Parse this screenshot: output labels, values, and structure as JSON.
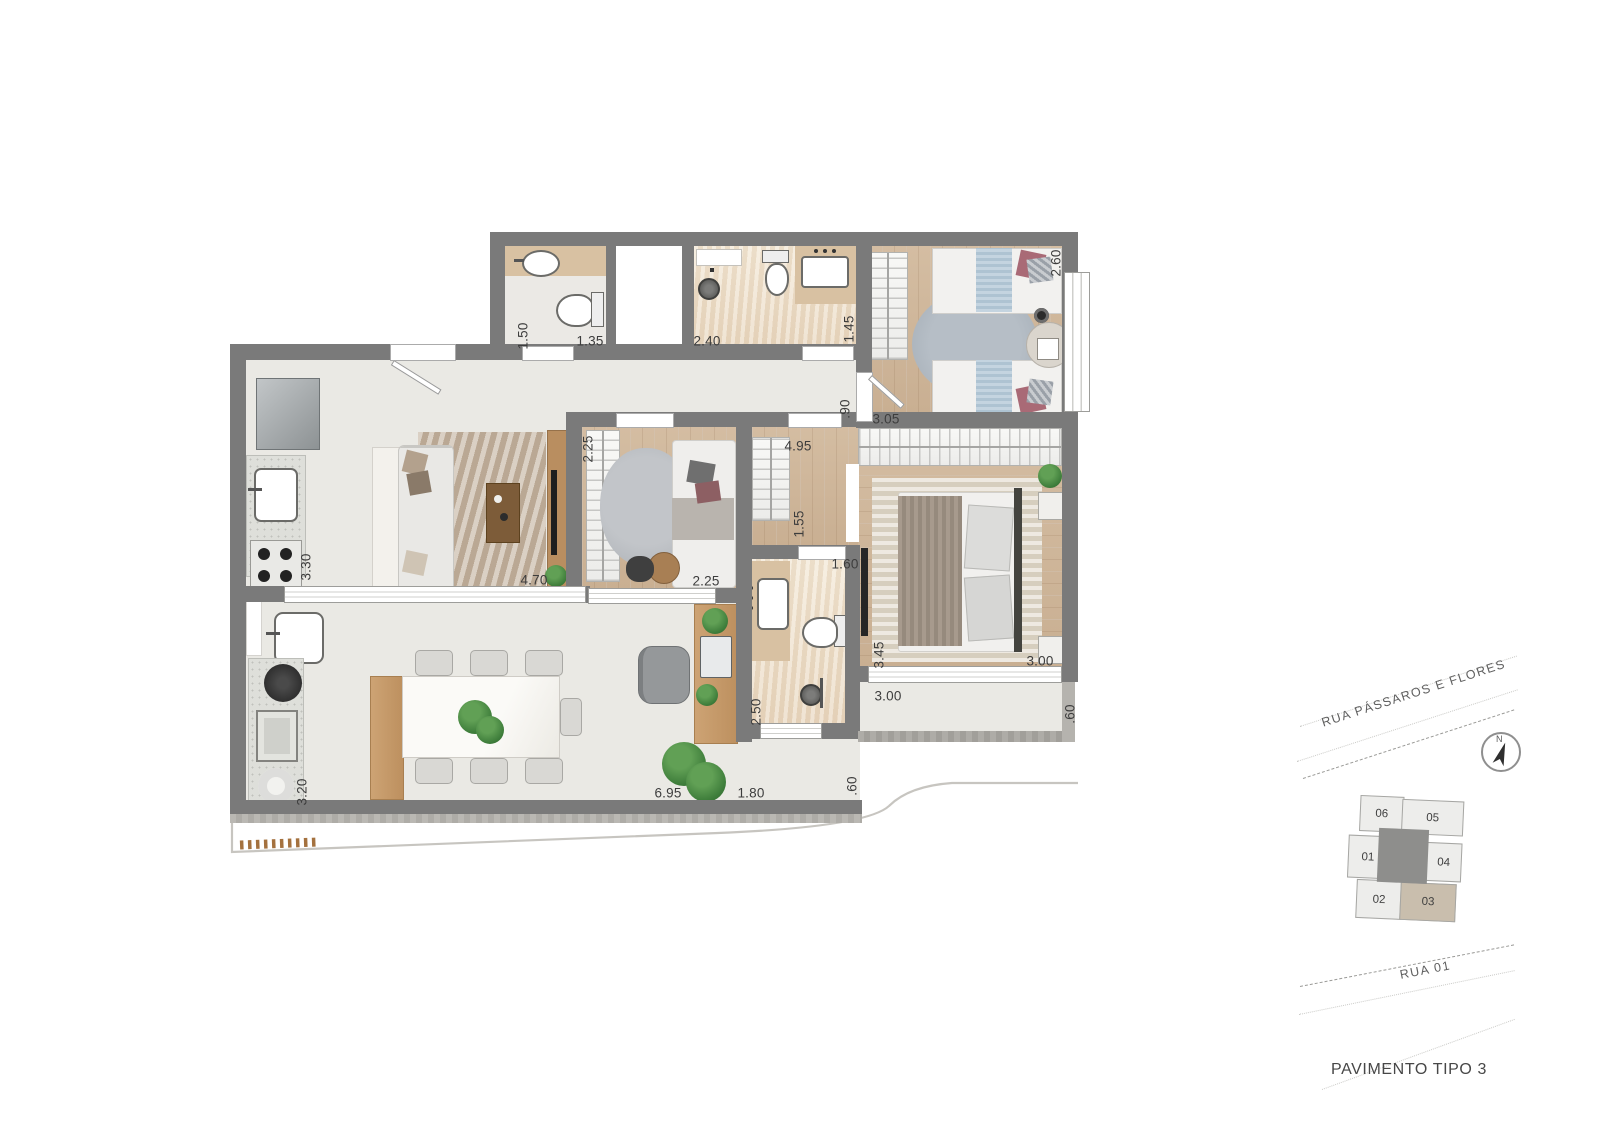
{
  "plan": {
    "dims": {
      "bath1_depth": "1.50",
      "bath1_width": "1.35",
      "bath2_width": "2.40",
      "bath2_depth": "1.45",
      "bedroom1_depth": "2.60",
      "bedroom1_width": "3.05",
      "hall_width": ".90",
      "suite_length": "4.95",
      "suite_hall_width": "1.55",
      "office_depth": "2.25",
      "office_width": "2.25",
      "suite_bath_width": "1.60",
      "suite_bath_depth": "2.50",
      "master_depth": "3.45",
      "master_width": "3.00",
      "kitchen_depth": "3.30",
      "living_width": "4.70",
      "terrace_depth": "3.20",
      "terrace_length": "6.95",
      "nook_width": "1.80",
      "nook_edge": ".60",
      "balcony_width": "3.00",
      "balcony_depth": ".60"
    },
    "colors": {
      "wall": "#7a7a7a",
      "wood_floor": "#cfb79c",
      "tile_floor": "#eae9e4",
      "stone_floor": "#efe3d1",
      "counter_marble": "#d8c1a2",
      "bed_blue": "#b9ccd9",
      "pillow_maroon": "#a96a76",
      "plant_green": "#3d7c3a"
    }
  },
  "site": {
    "street_top": "RUA PÁSSAROS E FLORES",
    "street_bottom": "RUA 01",
    "north": "N",
    "units": {
      "u01": "01",
      "u02": "02",
      "u03": "03",
      "u04": "04",
      "u05": "05",
      "u06": "06"
    },
    "highlighted_unit": "03",
    "highlight_color": "#c9bead",
    "caption": "PAVIMENTO TIPO 3"
  }
}
